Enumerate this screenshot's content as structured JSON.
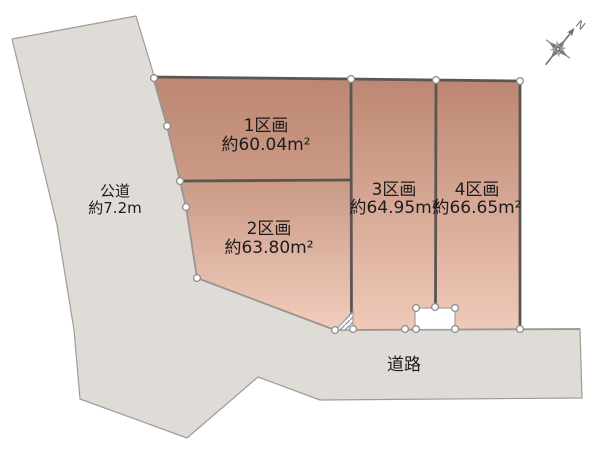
{
  "compass": {
    "north_label": "N"
  },
  "roads": {
    "public_road": {
      "name": "公道",
      "width": "約7.2m"
    },
    "front_road": {
      "name": "道路"
    }
  },
  "plots": [
    {
      "name": "1区画",
      "area": "約60.04m²"
    },
    {
      "name": "2区画",
      "area": "約63.80m²"
    },
    {
      "name": "3区画",
      "area": "約64.95m²"
    },
    {
      "name": "4区画",
      "area": "約66.65m²"
    }
  ],
  "colors": {
    "plot_gradient_top": "#bc8772",
    "plot_gradient_bottom": "#f3cdbd",
    "road_fill": "#dfdbd7",
    "plot_border_dark": "#5c5553",
    "road_border": "#a19b96",
    "text": "#1c1c1c"
  }
}
